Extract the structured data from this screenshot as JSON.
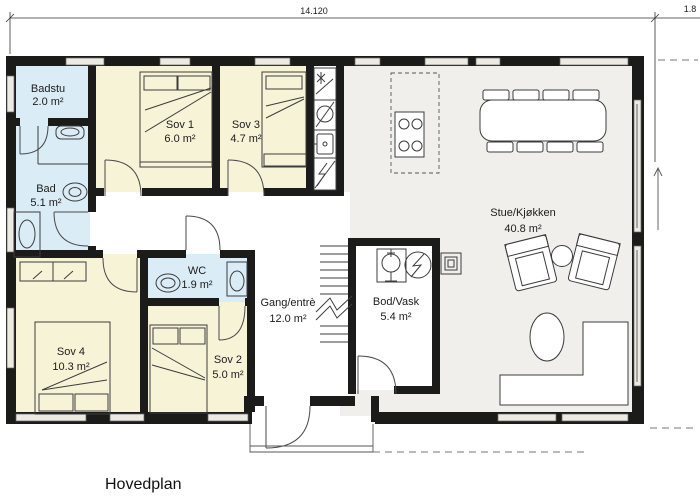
{
  "title": "Hovedplan",
  "dimensions": {
    "top_width": "14.120",
    "right_width": "1.8"
  },
  "rooms": {
    "badstu": {
      "name": "Badstu",
      "area": "2.0 m²"
    },
    "bad": {
      "name": "Bad",
      "area": "5.1 m²"
    },
    "sov1": {
      "name": "Sov 1",
      "area": "6.0 m²"
    },
    "sov3": {
      "name": "Sov 3",
      "area": "4.7 m²"
    },
    "wc": {
      "name": "WC",
      "area": "1.9 m²"
    },
    "sov4": {
      "name": "Sov 4",
      "area": "10.3 m²"
    },
    "sov2": {
      "name": "Sov 2",
      "area": "5.0 m²"
    },
    "gang": {
      "name": "Gang/entrè",
      "area": "12.0 m²"
    },
    "bod": {
      "name": "Bod/Vask",
      "area": "5.4 m²"
    },
    "stue": {
      "name": "Stue/Kjøkken",
      "area": "40.8 m²"
    }
  },
  "colors": {
    "bedroom": "#f6f3d6",
    "bathroom": "#daecf5",
    "living": "#f0efeb",
    "wall": "#1b1b19",
    "background": "#ffffff"
  }
}
